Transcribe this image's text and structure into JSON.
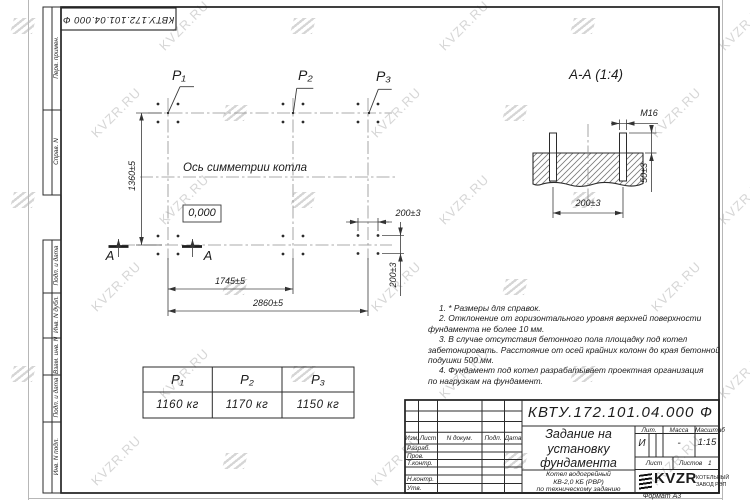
{
  "watermark": {
    "text": "KVZR.RU"
  },
  "top_stamp": {
    "doc_number": "КВТУ.172.101.04.000  Ф"
  },
  "margin_fields": {
    "labels": [
      "Перв. примен.",
      "Справ. N",
      "Подп. и дата",
      "Инв. N дубл.",
      "Взам. инв. N",
      "Подп. и дата",
      "Инв. N подл."
    ]
  },
  "plan": {
    "support_labels": {
      "p1": "P₁",
      "p2": "P₂",
      "p3": "P₃"
    },
    "axis_label": "Ось симметрии котла",
    "elevation_mark": "0,000",
    "section_letter": "А",
    "dims": {
      "height": "1360±5",
      "width_mid": "1745±5",
      "width_total": "2860±5",
      "bolt_spacing_x": "200±3",
      "bolt_spacing_y": "200±3"
    }
  },
  "section_view": {
    "title": "А-А (1:4)",
    "dims": {
      "thread": "M16",
      "protrusion": "50±3",
      "spacing": "200±3"
    }
  },
  "notes": {
    "lines": [
      "1. * Размеры для справок.",
      "2. Отклонение от горизонтального уровня верхней поверхности",
      "фундамента не более 10 мм.",
      "3. В случае отсутствия бетонного пола площадку под котел",
      "забетонировать. Расстояние от осей крайних колонн до края бетонной",
      "подушки 500 мм.",
      "4. Фундамент под котел разрабатывает проектная организация",
      "по нагрузкам на фундамент."
    ]
  },
  "loads_table": {
    "headers": [
      "P₁",
      "P₂",
      "P₃"
    ],
    "values": [
      "1160 кг",
      "1170 кг",
      "1150 кг"
    ]
  },
  "title_block": {
    "doc_number": "КВТУ.172.101.04.000  Ф",
    "title_lines": [
      "Задание на",
      "установку",
      "фундамента"
    ],
    "product_lines": [
      "Котел водогрейный",
      "КВ-2,0 КБ (РВР)",
      "по техническому заданию"
    ],
    "change_header": {
      "izm": "Изм.",
      "list": "Лист",
      "doc": "N докум.",
      "podp": "Подп.",
      "data": "Дата"
    },
    "sign_labels": [
      "Разраб.",
      "Пров.",
      "Т.контр.",
      "Н.контр.",
      "Утв."
    ],
    "lit": {
      "label": "Лит.",
      "value": "И"
    },
    "mass": {
      "label": "Масса",
      "value": "-"
    },
    "scale": {
      "label": "Масштаб",
      "value": "1:15"
    },
    "sheet": {
      "label": "Лист",
      "sheets_label": "Листов",
      "sheets_value": "1"
    },
    "company": {
      "logo": "KVZR",
      "name_line1": "КОТЕЛЬНЫЙ",
      "name_line2": "ЗАВОД РЭП"
    },
    "format": "Формат А3"
  }
}
